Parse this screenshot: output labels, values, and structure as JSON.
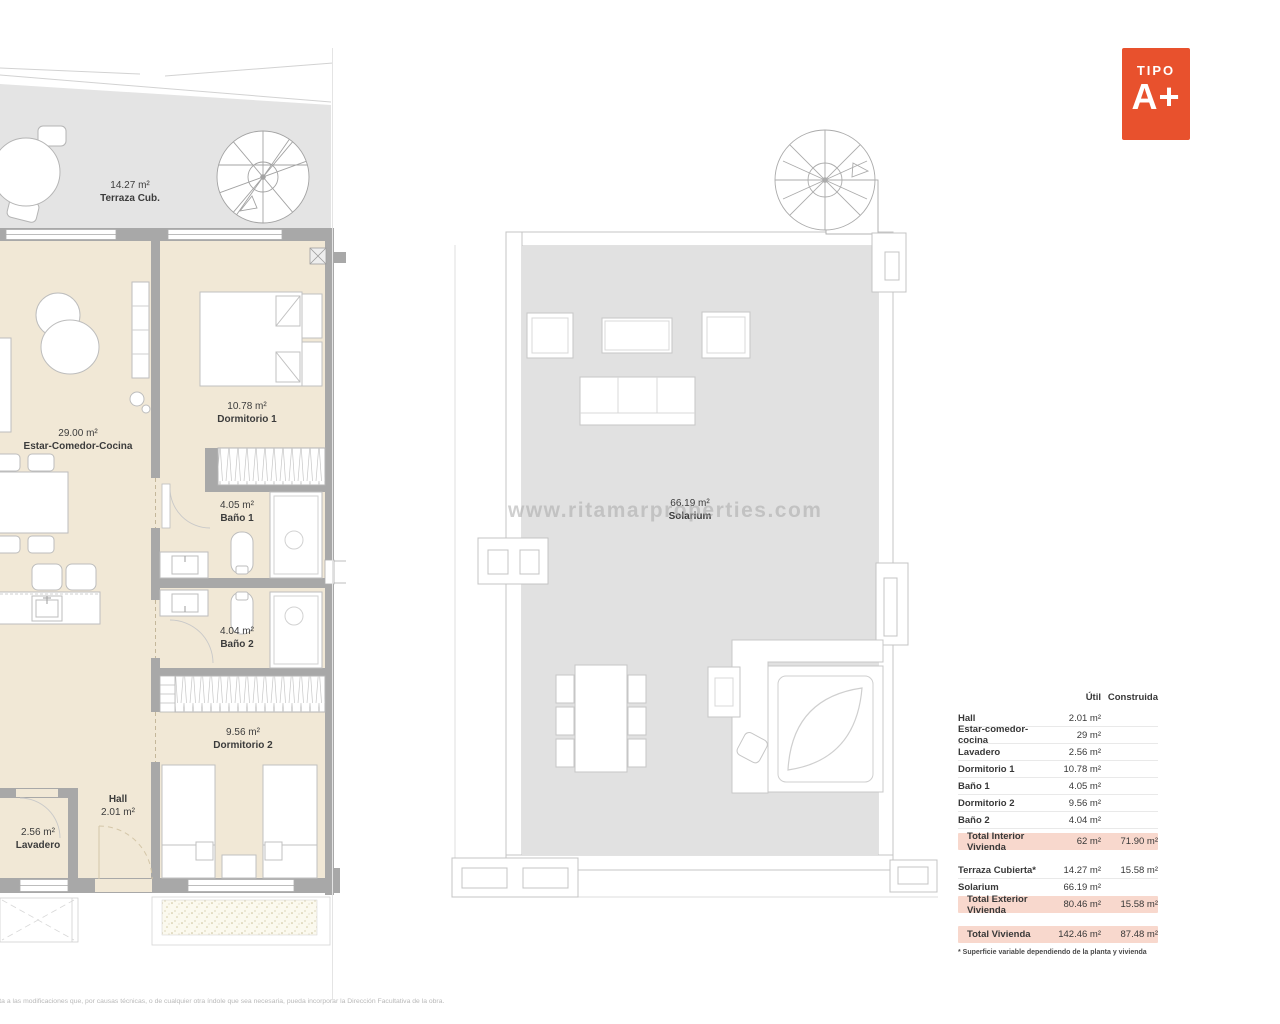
{
  "page": {
    "watermark": "www.ritamarproperties.com",
    "disclaimer": "jeta a las modificaciones que, por causas técnicas, o de cualquier otra índole que sea necesaria, pueda incorporar la Dirección Facultativa de la obra."
  },
  "badge": {
    "tipo_label": "TIPO",
    "type_label": "A+"
  },
  "apartment_plan": {
    "terraza": {
      "area": "14.27 m²",
      "name": "Terraza Cub."
    },
    "estar": {
      "area": "29.00 m²",
      "name": "Estar-Comedor-Cocina"
    },
    "dormitorio1": {
      "area": "10.78 m²",
      "name": "Dormitorio 1"
    },
    "bano1": {
      "area": "4.05 m²",
      "name": "Baño 1"
    },
    "bano2": {
      "area": "4.04 m²",
      "name": "Baño 2"
    },
    "dormitorio2": {
      "area": "9.56 m²",
      "name": "Dormitorio 2"
    },
    "hall": {
      "name": "Hall",
      "area": "2.01 m²"
    },
    "lavadero": {
      "area": "2.56 m²",
      "name": "Lavadero"
    }
  },
  "solarium_plan": {
    "solarium": {
      "area": "66.19 m²",
      "name": "Solarium"
    }
  },
  "surface_table": {
    "col_util": "Útil",
    "col_construida": "Construida",
    "rows": [
      {
        "label": "Hall",
        "util": "2.01 m²",
        "construida": ""
      },
      {
        "label": "Estar-comedor-cocina",
        "util": "29 m²",
        "construida": ""
      },
      {
        "label": "Lavadero",
        "util": "2.56 m²",
        "construida": ""
      },
      {
        "label": "Dormitorio 1",
        "util": "10.78 m²",
        "construida": ""
      },
      {
        "label": "Baño 1",
        "util": "4.05 m²",
        "construida": ""
      },
      {
        "label": "Dormitorio 2",
        "util": "9.56 m²",
        "construida": ""
      },
      {
        "label": "Baño 2",
        "util": "4.04 m²",
        "construida": ""
      }
    ],
    "total_interior": {
      "label": "Total Interior Vivienda",
      "util": "62 m²",
      "construida": "71.90 m²"
    },
    "exterior_rows": [
      {
        "label": "Terraza Cubierta*",
        "util": "14.27 m²",
        "construida": "15.58 m²"
      },
      {
        "label": "Solarium",
        "util": "66.19 m²",
        "construida": ""
      }
    ],
    "total_exterior": {
      "label": "Total Exterior Vivienda",
      "util": "80.46 m²",
      "construida": "15.58 m²"
    },
    "total_vivienda": {
      "label": "Total Vivienda",
      "util": "142.46 m²",
      "construida": "87.48 m²"
    },
    "footnote": "* Superficie variable dependiendo de la planta y vivienda"
  },
  "colors": {
    "accent": "#e8512d",
    "highlight_pink": "#f8d8cd",
    "interior_beige": "#f1e8d6",
    "floor_gray": "#e2e2e2",
    "wall_gray": "#a8a8a8"
  }
}
